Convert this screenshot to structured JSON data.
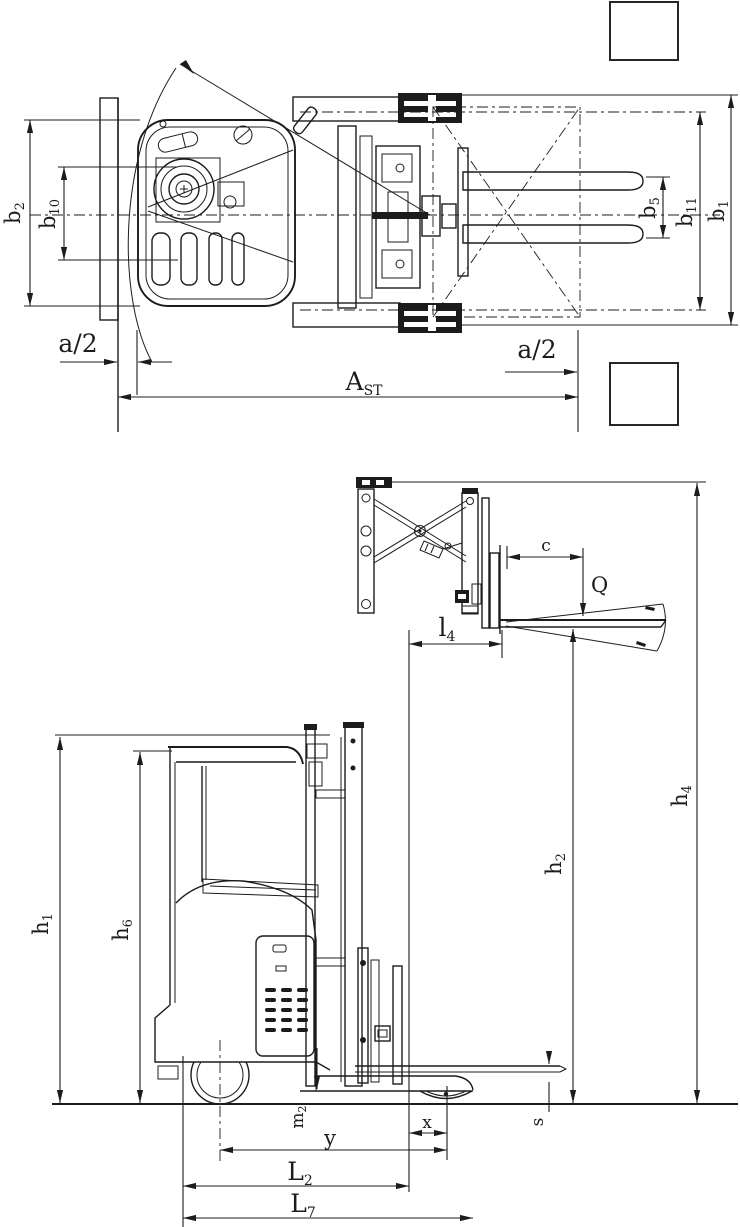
{
  "colors": {
    "line": "#1c1c1c",
    "background": "#ffffff"
  },
  "dimension_labels": {
    "top_view": {
      "b2": {
        "base": "b",
        "sub": "2"
      },
      "b10": {
        "base": "b",
        "sub": "10"
      },
      "b5": {
        "base": "b",
        "sub": "5"
      },
      "b11": {
        "base": "b",
        "sub": "11"
      },
      "b1": {
        "base": "b",
        "sub": "1"
      },
      "a2_left": {
        "text": "a/2"
      },
      "a2_right": {
        "text": "a/2"
      },
      "ast": {
        "base": "A",
        "sub": "ST"
      }
    },
    "side_view": {
      "c": {
        "text": "c"
      },
      "q": {
        "text": "Q"
      },
      "l4": {
        "base": "l",
        "sub": "4"
      },
      "h1": {
        "base": "h",
        "sub": "1"
      },
      "h6": {
        "base": "h",
        "sub": "6"
      },
      "h2": {
        "base": "h",
        "sub": "2"
      },
      "h4": {
        "base": "h",
        "sub": "4"
      },
      "m2": {
        "base": "m",
        "sub": "2"
      },
      "s": {
        "text": "s"
      },
      "x": {
        "text": "x"
      },
      "y": {
        "text": "y"
      },
      "L2": {
        "base": "L",
        "sub": "2"
      },
      "L7": {
        "base": "L",
        "sub": "7"
      }
    }
  }
}
